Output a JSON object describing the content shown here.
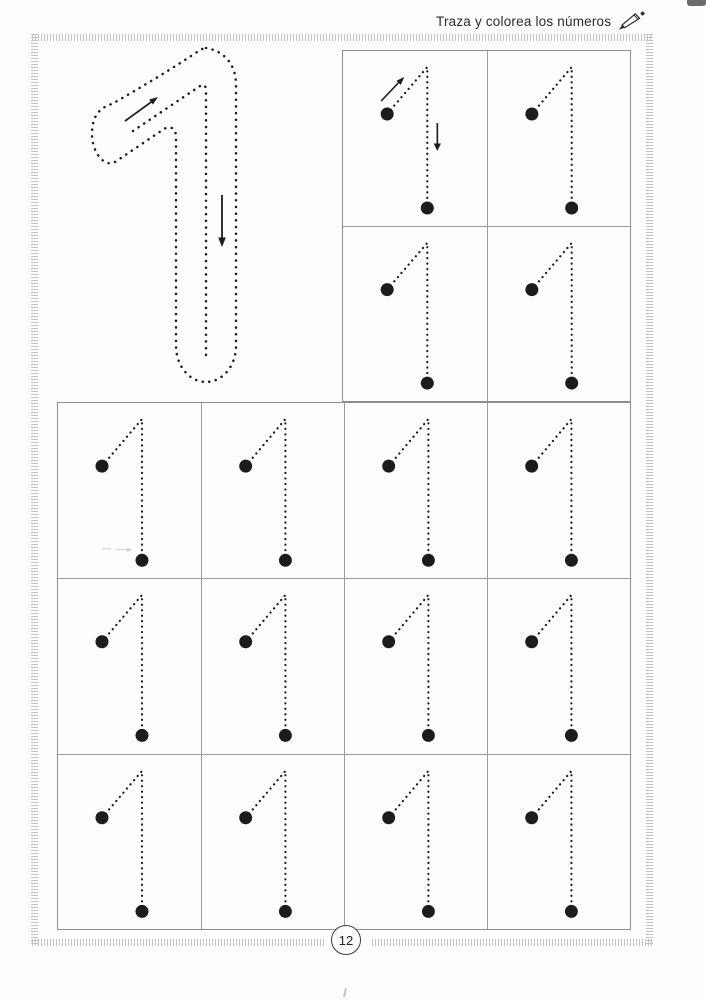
{
  "header": {
    "title": "Traza y colorea los números",
    "icon": "pencil-icon"
  },
  "worksheet": {
    "numeral": "1",
    "model": {
      "description": "large dotted outline numeral to trace",
      "direction_arrows": [
        "up-right",
        "down"
      ]
    },
    "top_grid": {
      "rows": 2,
      "cols": 2,
      "arrow_cells": [
        0
      ]
    },
    "bottom_grid": {
      "rows": 3,
      "cols": 4,
      "artifact_cells": [
        0
      ]
    }
  },
  "footer": {
    "page_number": "12"
  },
  "colors": {
    "ink": "#1c1c1c",
    "grid_line": "#9c9c9c",
    "border_tick": "#c3c3c3",
    "paper": "#fdfdfd"
  }
}
